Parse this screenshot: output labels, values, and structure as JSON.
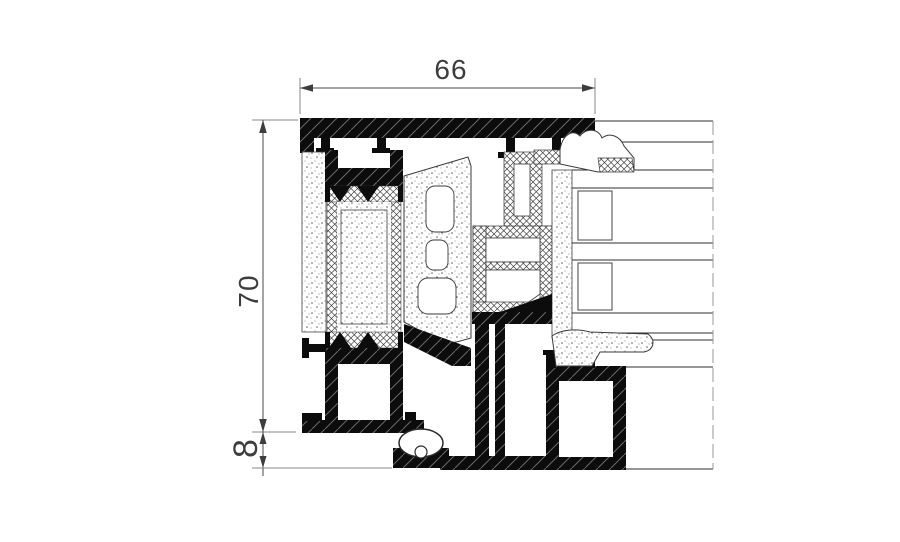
{
  "drawing": {
    "label": "Aluminium window profile cross-section",
    "dimensions": {
      "width": "66",
      "height": "70",
      "offset": "8"
    },
    "colors": {
      "background": "#ffffff",
      "aluminium": "#0c0c0c",
      "dimension_text": "#3d3d3d",
      "dimension_line": "#4a4a4a",
      "witness_line": "#8a8a8a",
      "outline": "#3a3a3a"
    }
  }
}
